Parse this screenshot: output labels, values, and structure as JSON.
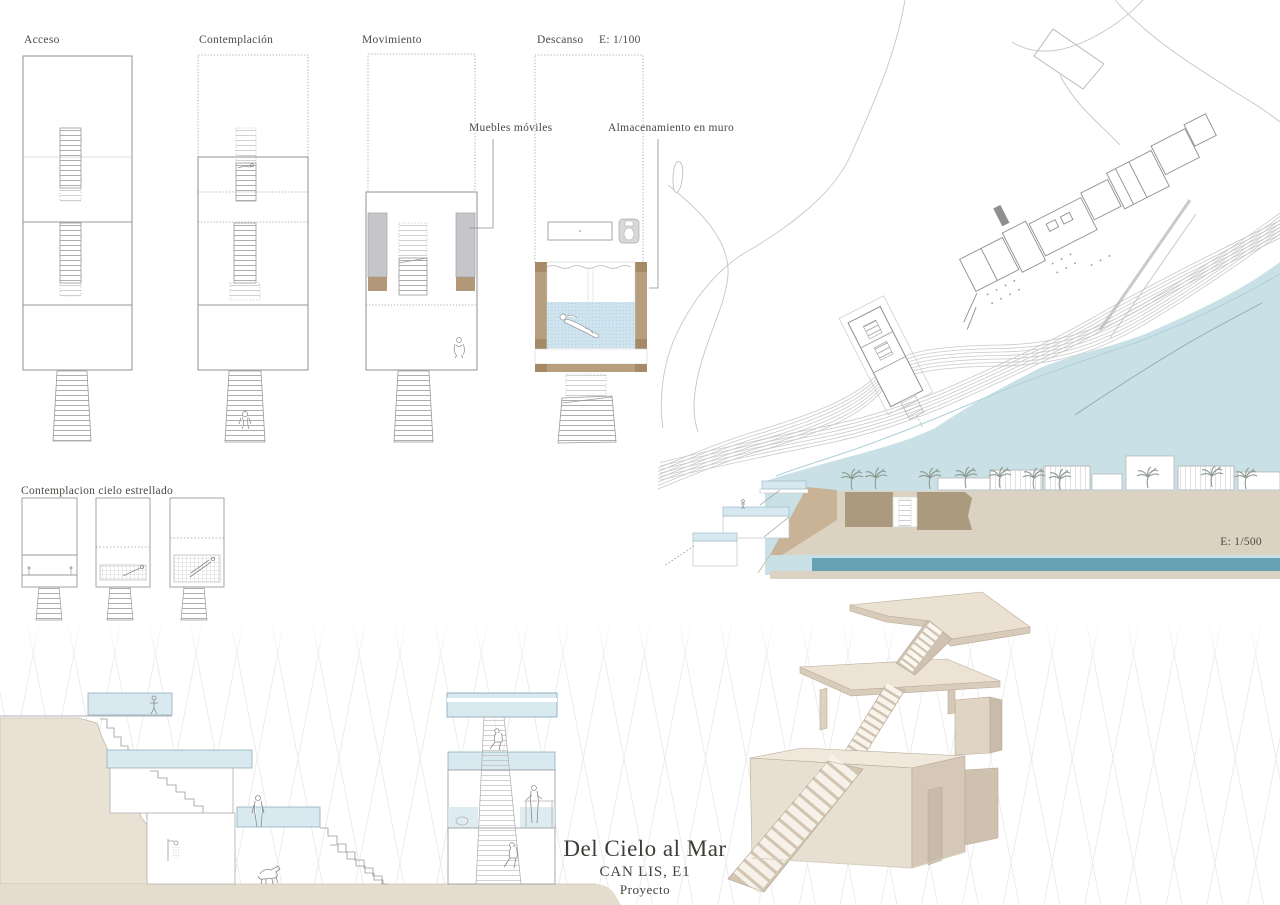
{
  "board": {
    "plans": {
      "scale_label": "E: 1/100",
      "items": [
        {
          "label": "Acceso"
        },
        {
          "label": "Contemplación"
        },
        {
          "label": "Movimiento"
        },
        {
          "label": "Descanso"
        }
      ],
      "annotations": {
        "mobile_furniture": "Muebles móviles",
        "wall_storage": "Almacenamiento en muro"
      }
    },
    "night_series": {
      "label": "Contemplacion cielo estrellado"
    },
    "site_section": {
      "scale_label": "E: 1/500"
    },
    "title_block": {
      "title": "Del Cielo al Mar",
      "subtitle": "CAN LIS, E1",
      "phase": "Proyecto"
    },
    "palette": {
      "sea_plan": "#c9e1e6",
      "sea_section_band": "#67a2b4",
      "ground_beige": "#dbd2c2",
      "excavation_brown": "#ab9a7d",
      "cliff_beige": "#e9e2d4",
      "glass_blue": "#d6e9f0",
      "wall_tan": "#b79e7e",
      "furniture_gray": "#c6c6ca",
      "pool_blue": "#cfe4ef",
      "model_cream": "#ece4d6"
    }
  }
}
